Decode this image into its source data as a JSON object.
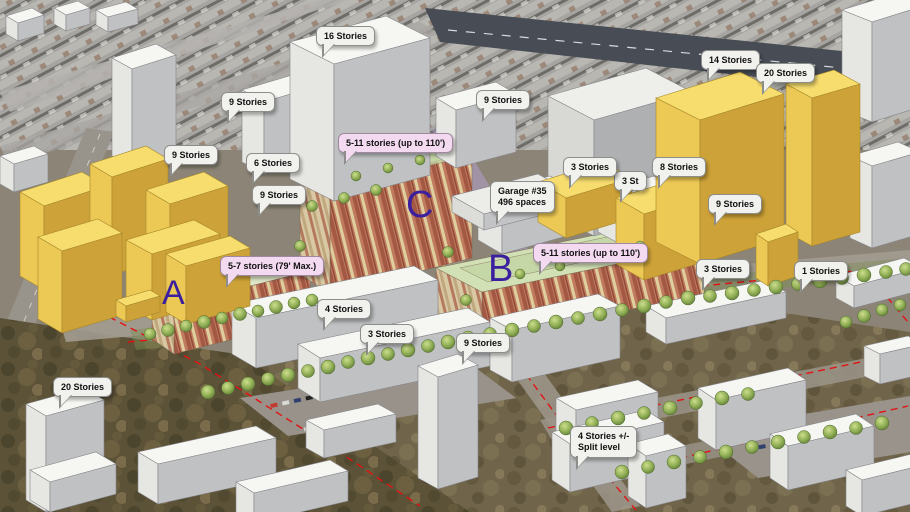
{
  "scene": {
    "kind": "3d-site-massing-model-over-aerial",
    "site_markers": [
      "A",
      "B",
      "C"
    ]
  },
  "letters": [
    {
      "label": "A"
    },
    {
      "label": "B"
    },
    {
      "label": "C"
    }
  ],
  "callouts": [
    {
      "id": "stories-16",
      "label": "16 Stories",
      "type": "white"
    },
    {
      "id": "stories-9-top",
      "label": "9 Stories",
      "type": "white"
    },
    {
      "id": "stories-9-left",
      "label": "9 Stories",
      "type": "white"
    },
    {
      "id": "stories-6",
      "label": "6 Stories",
      "type": "white"
    },
    {
      "id": "stories-9-mid",
      "label": "9 Stories",
      "type": "white"
    },
    {
      "id": "height-limit-c",
      "label": "5-11 stories (up to 110')",
      "type": "pink"
    },
    {
      "id": "stories-9-center",
      "label": "9 Stories",
      "type": "white"
    },
    {
      "id": "stories-14",
      "label": "14 Stories",
      "type": "white"
    },
    {
      "id": "stories-20-right",
      "label": "20 Stories",
      "type": "white"
    },
    {
      "id": "stories-3-garage",
      "label": "3 Stories",
      "type": "white"
    },
    {
      "id": "stories-3-hidden",
      "label": "3 St",
      "type": "white"
    },
    {
      "id": "stories-8",
      "label": "8 Stories",
      "type": "white"
    },
    {
      "id": "stories-9-right",
      "label": "9 Stories",
      "type": "white"
    },
    {
      "id": "garage-35",
      "label": "Garage #35\n496 spaces",
      "type": "white"
    },
    {
      "id": "height-limit-b",
      "label": "5-11 stories (up to 110')",
      "type": "pink"
    },
    {
      "id": "stories-3-right",
      "label": "3 Stories",
      "type": "white"
    },
    {
      "id": "stories-1",
      "label": "1 Stories",
      "type": "white"
    },
    {
      "id": "height-limit-a",
      "label": "5-7 stories (79' Max.)",
      "type": "pink"
    },
    {
      "id": "stories-4",
      "label": "4 Stories",
      "type": "white"
    },
    {
      "id": "stories-3-mid",
      "label": "3 Stories",
      "type": "white"
    },
    {
      "id": "stories-9-lower",
      "label": "9 Stories",
      "type": "white"
    },
    {
      "id": "stories-20-left",
      "label": "20 Stories",
      "type": "white"
    },
    {
      "id": "stories-4-split",
      "label": "4 Stories +/-\nSplit level",
      "type": "white"
    }
  ],
  "colors": {
    "massing_yellow": "#f7dd6e",
    "massing_white": "#f6f6f3",
    "callout_white": "#f1f1ee",
    "callout_pink": "#f4daf1",
    "site_letter_purple": "#3b1f9e",
    "boundary_red": "#e31212",
    "guide_yellow": "#e8d23c",
    "lavender_street": "#b7a0d6"
  }
}
